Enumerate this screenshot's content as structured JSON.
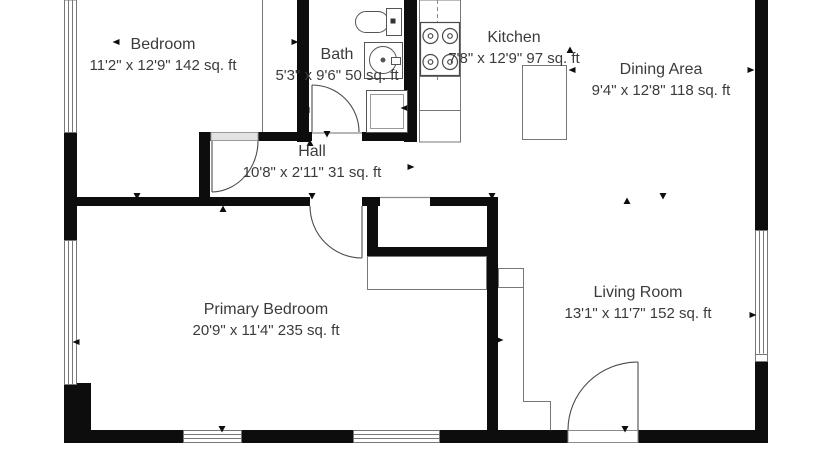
{
  "title": "Floor plan",
  "rooms": [
    {
      "id": "bedroom",
      "name": "Bedroom",
      "dimensions": "11'2\" x 12'9\" 142 sq. ft"
    },
    {
      "id": "bath",
      "name": "Bath",
      "dimensions": "5'3\" x 9'6\" 50 sq. ft"
    },
    {
      "id": "kitchen",
      "name": "Kitchen",
      "dimensions": "7'8\" x 12'9\" 97 sq. ft"
    },
    {
      "id": "dining-area",
      "name": "Dining Area",
      "dimensions": "9'4\" x 12'8\" 118 sq. ft"
    },
    {
      "id": "hall",
      "name": "Hall",
      "dimensions": "10'8\" x 2'11\" 31 sq. ft"
    },
    {
      "id": "primary-bedroom",
      "name": "Primary Bedroom",
      "dimensions": "20'9\" x 11'4\" 235 sq. ft"
    },
    {
      "id": "living-room",
      "name": "Living Room",
      "dimensions": "13'1\" x 11'7\" 152 sq. ft"
    }
  ],
  "fixtures": [
    "toilet-icon",
    "bathroom-sink-icon",
    "shower-icon",
    "stove-icon",
    "kitchen-counter",
    "kitchen-island"
  ],
  "colors": {
    "wall": "#0d0d0d",
    "thin_line": "#777777",
    "door_line": "#4a4a4a",
    "text": "#3b3b3b",
    "background": "#ffffff",
    "threshold_fill": "#e3e3e3"
  },
  "door_markers": [
    {
      "x": 116,
      "y": 42,
      "dir": "left"
    },
    {
      "x": 295,
      "y": 42,
      "dir": "right"
    },
    {
      "x": 306,
      "y": 110,
      "dir": "left"
    },
    {
      "x": 404,
      "y": 108,
      "dir": "left"
    },
    {
      "x": 310,
      "y": 143,
      "dir": "up"
    },
    {
      "x": 327,
      "y": 134,
      "dir": "down"
    },
    {
      "x": 223,
      "y": 209,
      "dir": "up"
    },
    {
      "x": 137,
      "y": 196,
      "dir": "down"
    },
    {
      "x": 312,
      "y": 196,
      "dir": "down"
    },
    {
      "x": 411,
      "y": 167,
      "dir": "right"
    },
    {
      "x": 492,
      "y": 196,
      "dir": "down"
    },
    {
      "x": 570,
      "y": 50,
      "dir": "up"
    },
    {
      "x": 572,
      "y": 70,
      "dir": "left"
    },
    {
      "x": 751,
      "y": 70,
      "dir": "right"
    },
    {
      "x": 627,
      "y": 201,
      "dir": "up"
    },
    {
      "x": 663,
      "y": 196,
      "dir": "down"
    },
    {
      "x": 500,
      "y": 340,
      "dir": "right"
    },
    {
      "x": 76,
      "y": 342,
      "dir": "left"
    },
    {
      "x": 753,
      "y": 315,
      "dir": "right"
    },
    {
      "x": 222,
      "y": 429,
      "dir": "down"
    },
    {
      "x": 625,
      "y": 429,
      "dir": "down"
    }
  ]
}
